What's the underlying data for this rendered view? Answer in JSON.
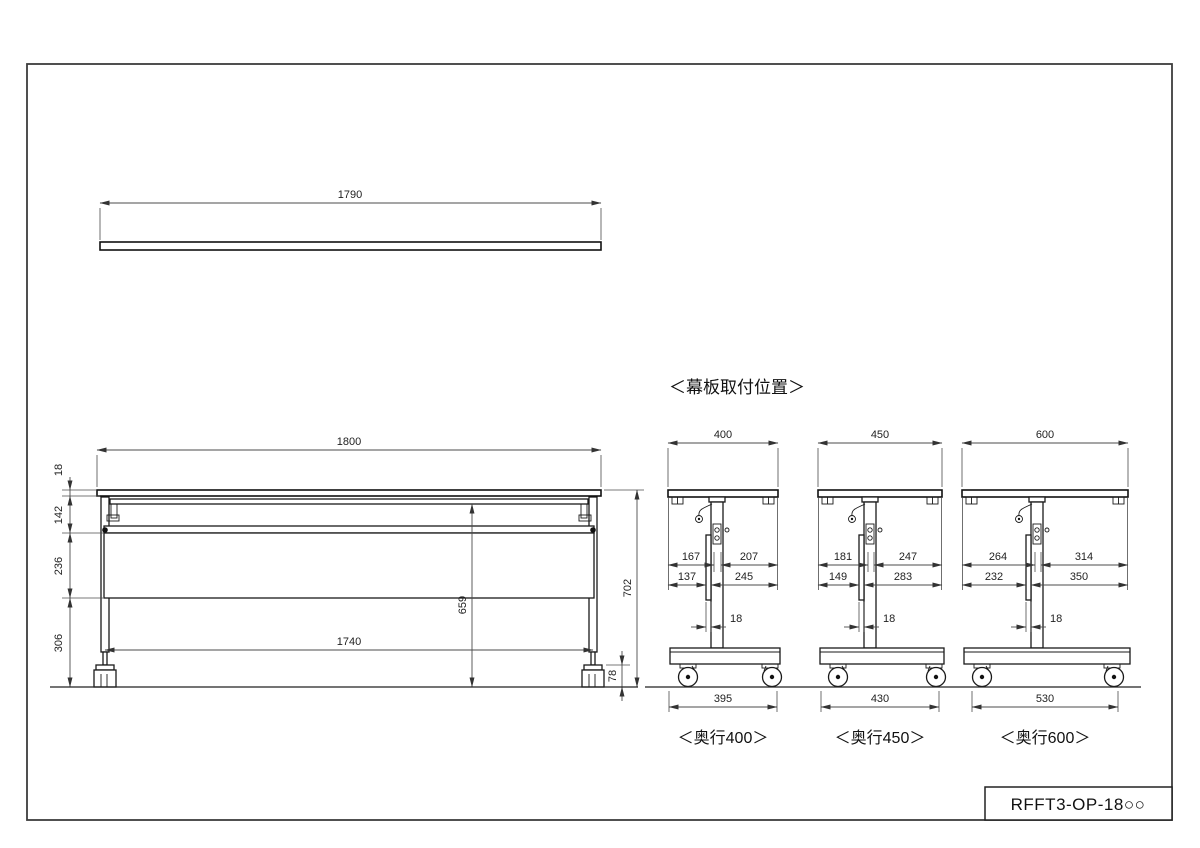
{
  "page": {
    "part_number": "RFFT3-OP-18○○",
    "section_label": "＜幕板取付位置＞"
  },
  "top_view": {
    "width": "1790"
  },
  "front_view": {
    "width": "1800",
    "top_thickness": "18",
    "frame_height": "142",
    "panel_height": "236",
    "lower_height": "306",
    "underside_height": "659",
    "overall_height": "702",
    "leg_span": "1740",
    "caster_height": "78"
  },
  "side_views": [
    {
      "label": "＜奥行400＞",
      "depth": "400",
      "upper_front": "167",
      "upper_rear": "207",
      "lower_front": "137",
      "lower_rear": "245",
      "panel_thickness": "18",
      "caster_span": "395"
    },
    {
      "label": "＜奥行450＞",
      "depth": "450",
      "upper_front": "181",
      "upper_rear": "247",
      "lower_front": "149",
      "lower_rear": "283",
      "panel_thickness": "18",
      "caster_span": "430"
    },
    {
      "label": "＜奥行600＞",
      "depth": "600",
      "upper_front": "264",
      "upper_rear": "314",
      "lower_front": "232",
      "lower_rear": "350",
      "panel_thickness": "18",
      "caster_span": "530"
    }
  ]
}
